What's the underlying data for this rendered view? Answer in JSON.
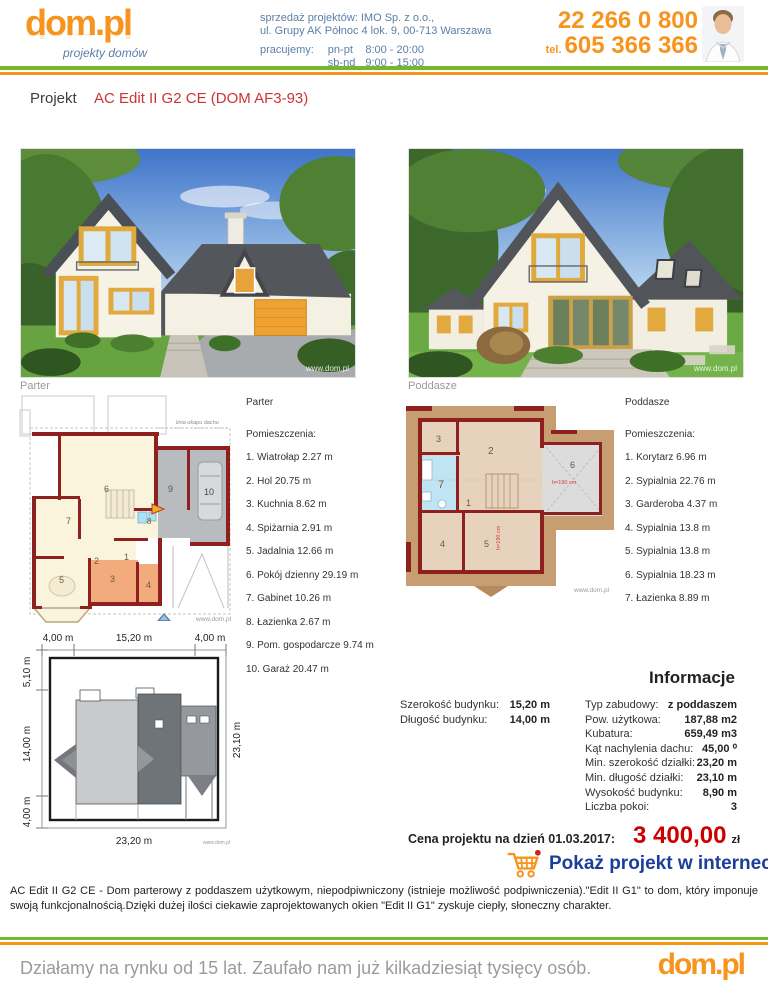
{
  "header": {
    "logo": "dom.pl",
    "tagline": "projekty domów",
    "seller_line1": "sprzedaż projektów: IMO Sp. z o.o.,",
    "seller_line2": "ul. Grupy AK Północ 4 lok. 9, 00-713 Warszawa",
    "hours_label": "pracujemy:",
    "hours_weekdays_label": "pn-pt",
    "hours_weekdays": "8:00 - 20:00",
    "hours_weekend_label": "sb-nd",
    "hours_weekend": "9:00 - 15:00",
    "phone1": "22 266 0 800",
    "phone2_label": "tel.",
    "phone2": "605 366 366"
  },
  "title": {
    "label": "Projekt",
    "name": "AC Edit II G2 CE (DOM AF3-93)"
  },
  "watermark": "www.dom.pl",
  "renders": {
    "left_caption": "Parter",
    "right_caption": "Poddasze"
  },
  "parter": {
    "heading": "Parter",
    "rooms_label": "Pomieszczenia:",
    "plan_note": "linia okapu dachu",
    "numbers": [
      "1",
      "2",
      "3",
      "4",
      "5",
      "6",
      "7",
      "8",
      "9",
      "10"
    ],
    "rooms": [
      "1. Wiatrołap 2.27 m",
      "2. Hol 20.75 m",
      "3. Kuchnia 8.62 m",
      "4. Spiżarnia 2.91 m",
      "5. Jadalnia 12.66 m",
      "6. Pokój dzienny 29.19 m",
      "7. Gabinet 10.26 m",
      "8. Łazienka 2.67 m",
      "9. Pom. gospodarcze 9.74 m",
      "10. Garaż 20.47 m"
    ]
  },
  "poddasze": {
    "heading": "Poddasze",
    "rooms_label": "Pomieszczenia:",
    "height_note": "h=190 cm",
    "numbers": [
      "1",
      "2",
      "3",
      "4",
      "5",
      "6",
      "7"
    ],
    "rooms": [
      "1. Korytarz 6.96 m",
      "2. Sypialnia 22.76 m",
      "3. Garderoba 4.37 m",
      "4. Sypialnia 13.8 m",
      "5. Sypialnia 13.8 m",
      "6. Sypialnia 18.23 m",
      "7. Łazienka 8.89 m"
    ]
  },
  "siteplan": {
    "dim_top_left": "4,00 m",
    "dim_top_center": "15,20 m",
    "dim_top_right": "4,00 m",
    "dim_left_top": "5,10 m",
    "dim_left_middle": "14,00 m",
    "dim_left_bottom": "4,00 m",
    "dim_right": "23,10 m",
    "dim_bottom": "23,20 m"
  },
  "informacje": {
    "heading": "Informacje",
    "left_rows": [
      {
        "label": "Szerokość budynku:",
        "value": "15,20 m"
      },
      {
        "label": "Długość budynku:",
        "value": "14,00 m"
      }
    ],
    "right_rows": [
      {
        "label": "Typ zabudowy:",
        "value": "z poddaszem"
      },
      {
        "label": "Pow. użytkowa:",
        "value": "187,88 m2"
      },
      {
        "label": "Kubatura:",
        "value": "659,49 m3"
      },
      {
        "label": "Kąt nachylenia dachu:",
        "value": "45,00 ⁰"
      },
      {
        "label": "Min. szerokość działki:",
        "value": "23,20 m"
      },
      {
        "label": "Min. długość działki:",
        "value": "23,10 m"
      },
      {
        "label": "Wysokość budynku:",
        "value": "8,90 m"
      },
      {
        "label": "Liczba pokoi:",
        "value": "3"
      }
    ]
  },
  "price": {
    "label": "Cena projektu na dzień 01.03.2017:",
    "value": "3 400,00",
    "currency": "zł"
  },
  "cta": {
    "label": "Pokaż projekt w internecie"
  },
  "description": "AC Edit II G2 CE - Dom parterowy z poddaszem użytkowym, niepodpiwniczony (istnieje możliwość podpiwniczenia).\"Edit II G1\" to dom, który imponuje swoją funkcjonalnością.Dzięki dużej ilości ciekawie zaprojektowanych okien \"Edit II G1\" zyskuje ciepły, słoneczny charakter.",
  "footer": {
    "slogan": "Działamy na rynku od 15 lat. Zaufało nam już kilkadziesiąt tysięcy osób.",
    "logo": "dom.pl"
  }
}
